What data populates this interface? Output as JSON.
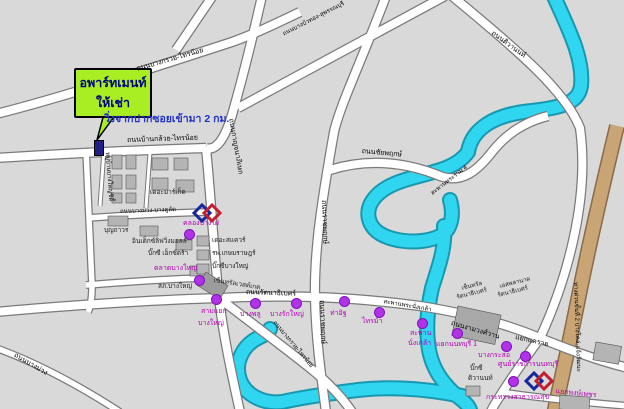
{
  "callout": {
    "line1": "อพาร์ทเมนท์",
    "line2": "ให้เช่า"
  },
  "note": "วิ่งจากปากซอยเข้ามา 2 กม.",
  "colors": {
    "river": "#30d5f0",
    "river_edge": "#1898b0",
    "road_fill": "#ffffff",
    "road_edge": "#7a7a7a",
    "expressway": "#c9a474",
    "expressway_edge": "#8a6a48",
    "station_dot": "#b232e8",
    "station_text": "#b400b4",
    "callout_green": "#a8ee22",
    "callout_text": "#000080",
    "note_blue": "#2233cc",
    "background": "#d9d9d9"
  },
  "roads": {
    "ban_kluai_sai_noi": "ถนนบ้านกล้วย-ไทรน้อย",
    "bang_kruai_sai_noi_nw": "ถนนบางกรวย-ไทรน้อย",
    "bang_kruai_sai_noi_se": "ถนนบางกรวย-ไทรน้อย",
    "kanchanaphisek": "ถนนกาญจนาภิเษก",
    "bang_bua_thong": "ถนนบางบัวทอง-สุพรรณบุรี",
    "chaiyaphruek": "ถนนชัยพฤกษ์",
    "rama4_bridge": "สะพานพระราม 4",
    "ratchaphruek_n": "ถนนราชพฤกษ์",
    "ratchaphruek_s": "ถนนราชพฤกษ์",
    "rattanathibet": "ถนนรัตนาธิเบศร์",
    "phra_nang_klao_bridge": "สะพานพระนั่งเกล้า",
    "ngam_wong_wan": "ถนนงามวงศ์วาน",
    "tiwanon": "ถนนติวานนท์",
    "bang_khu_lat": "ถนนบางม่วง-บางคูลัด",
    "bang_muang": "ถนนบางม่วง",
    "expressway": "ทางด่วนขั้นที่ 2 บางโคล่-แจ้งวัฒนะ",
    "village": "หมู่บ้านบางใหญ่ซิตี้"
  },
  "junctions": {
    "khae_rai": "แยกแคราย",
    "phong_phet": "แยกพงษ์เพชร"
  },
  "stations": [
    {
      "name": "คลองบางไผ่"
    },
    {
      "name": "ตลาดบางใหญ่"
    },
    {
      "name": "สามแยก",
      "line2": "บางใหญ่"
    },
    {
      "name": "บางพลู"
    },
    {
      "name": "บางรักใหญ่"
    },
    {
      "name": "ท่าอิฐ"
    },
    {
      "name": "ไทรม้า"
    },
    {
      "name": "สะพาน",
      "line2": "นั่งเกล้า"
    },
    {
      "name": "แยกนนทบุรี 1"
    },
    {
      "name": "บางกระสอ"
    },
    {
      "name": "ศูนย์ราชการนนทบุรี"
    },
    {
      "name": "กระทรวงสาธารณสุข"
    }
  ],
  "places": [
    {
      "name": "เดอะมาร์เก็ต"
    },
    {
      "name": "บุญถาวร"
    },
    {
      "name": "อินเด็กซ์ลิฟวิ่งมอลล์"
    },
    {
      "name": "บิ๊กซี เอ็กซ์ตร้า"
    },
    {
      "name": "สภ.บางใหญ่"
    },
    {
      "name": "เดอะสแควร์"
    },
    {
      "name": "รพ.เกษมราษฎร์"
    },
    {
      "name": "บิ๊กซีบางใหญ่"
    },
    {
      "name": "เซ็นทรัลเวสต์เกต"
    },
    {
      "name": "เซ็นทรัล",
      "line2": "รัตนาธิเบศร์"
    },
    {
      "name": "เอสพลานาด",
      "line2": "รัตนาธิเบศร์"
    },
    {
      "name": "บิ๊กซี",
      "line2": "ติวานนท์"
    }
  ]
}
